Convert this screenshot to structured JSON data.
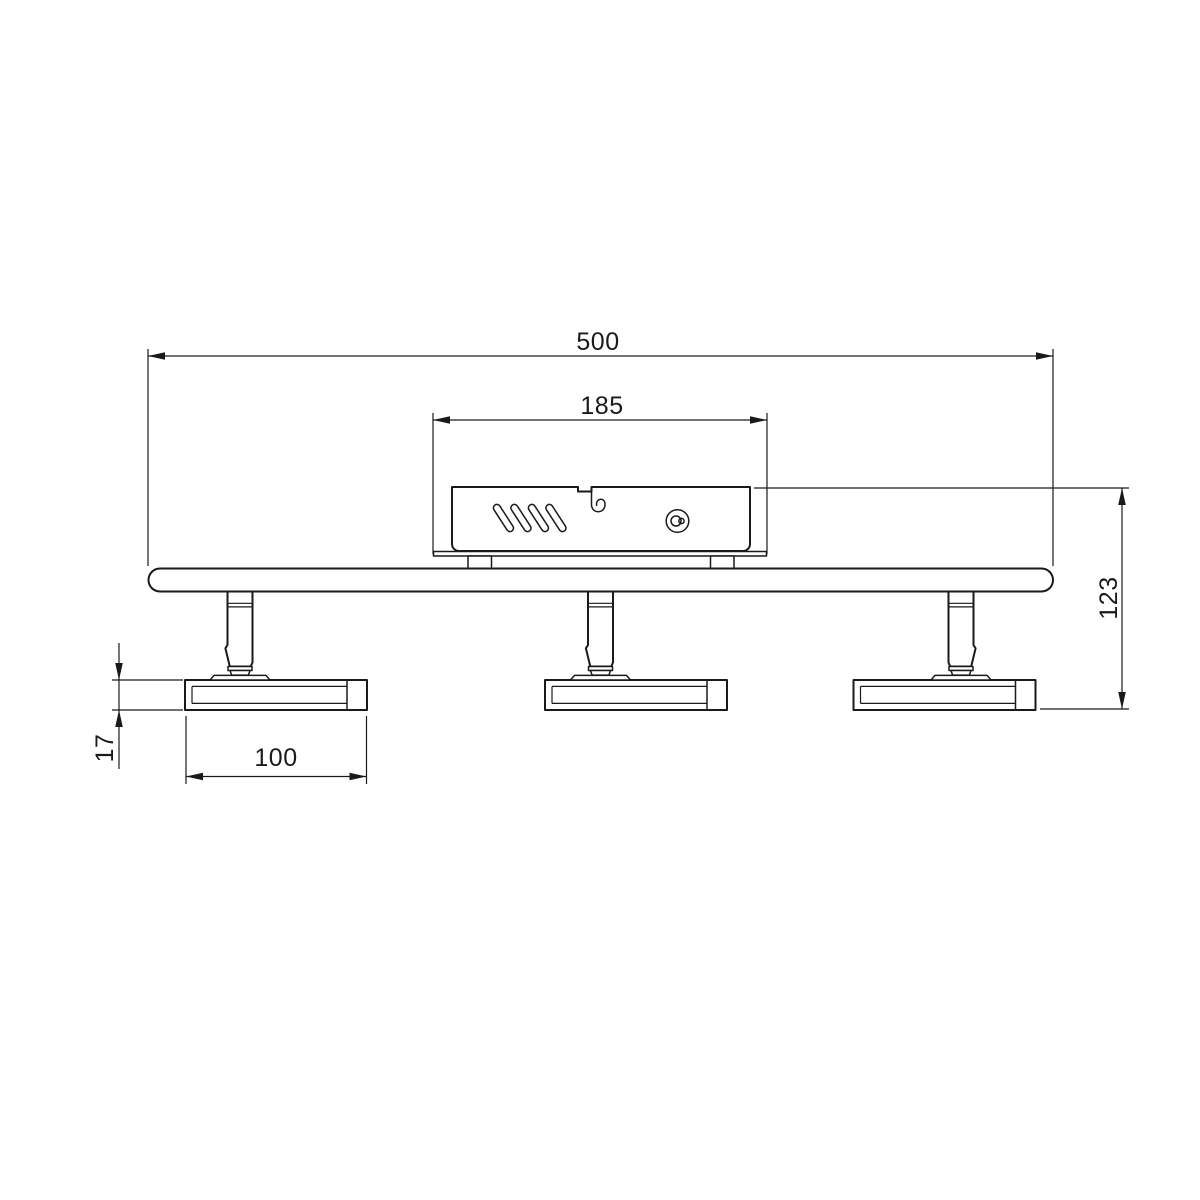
{
  "canvas": {
    "background": "#ffffff",
    "line_color": "#1a1a1a"
  },
  "dimensions": {
    "overall_width": "500",
    "canopy_width": "185",
    "overall_height": "123",
    "head_thickness": "17",
    "head_width": "100"
  }
}
